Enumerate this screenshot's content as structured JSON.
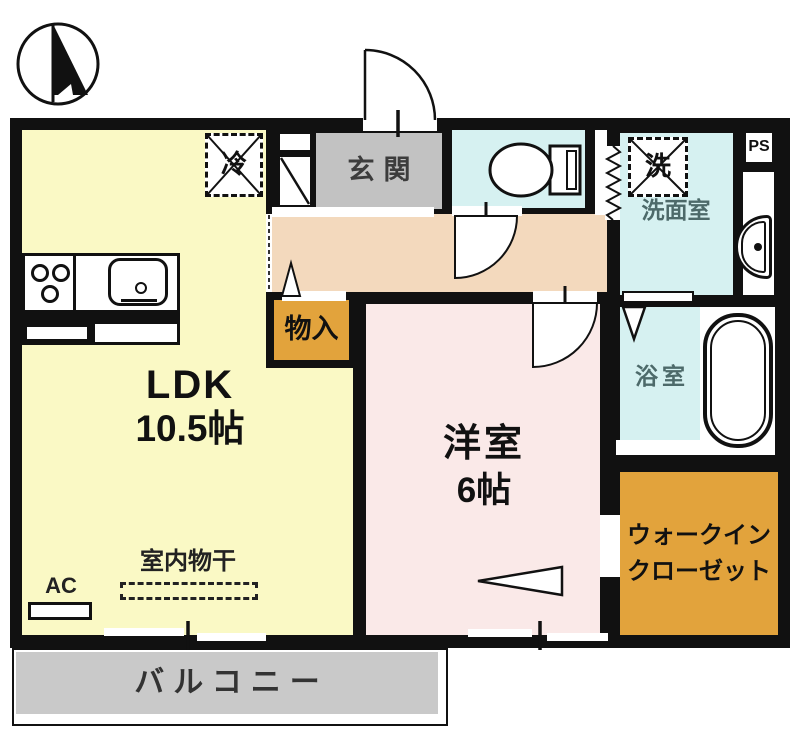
{
  "plan": {
    "rooms": {
      "ldk": {
        "label": "LDK",
        "size": "10.5帖"
      },
      "western_room": {
        "label": "洋室",
        "size": "6帖"
      },
      "entrance": {
        "label": "玄関"
      },
      "washroom": {
        "label": "洗面室"
      },
      "bathroom": {
        "label": "浴室"
      },
      "walk_in_closet": {
        "label_line1": "ウォークイン",
        "label_line2": "クローゼット"
      },
      "storage": {
        "label": "物入"
      },
      "balcony": {
        "label": "バルコニー"
      }
    },
    "fixtures": {
      "refrigerator": {
        "label": "冷"
      },
      "washing_machine": {
        "label": "洗"
      },
      "pipe_space": {
        "label": "PS"
      },
      "air_conditioner": {
        "label": "AC"
      },
      "indoor_drying": {
        "label": "室内物干"
      }
    },
    "icons": [
      "north-compass-icon",
      "entrance-door-arc",
      "toilet-icon",
      "washbasin-icon",
      "bathtub-icon",
      "stove-icon",
      "kitchen-sink-icon",
      "folding-door-icon",
      "accordion-door-icon",
      "door-swing-arc",
      "opening-direction-arrow"
    ],
    "colors": {
      "wall": "#111111",
      "ldk": "#FAF9C5",
      "western_room": "#FAE9E8",
      "corridor": "#F3D9BD",
      "wet_area": "#D6F1F1",
      "closet_storage": "#E2A33C",
      "entrance_floor": "#C2C2C2",
      "balcony": "#C9C9C9"
    }
  }
}
